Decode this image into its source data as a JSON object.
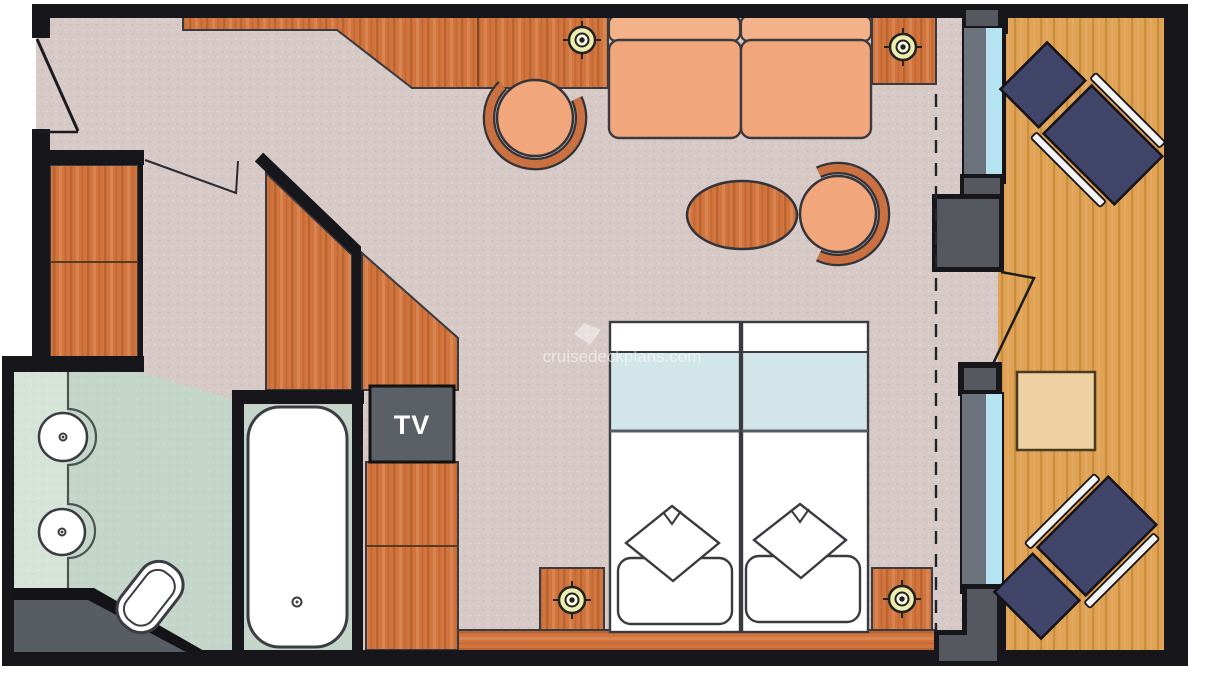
{
  "labels": {
    "tv": "TV"
  },
  "watermark": {
    "text": "cruisedeckplans.com"
  },
  "palette": {
    "wall": "#17171b",
    "carpet": "#d7c9c6",
    "bath_floor": "#c4d6c9",
    "bath_counter": "#d6e4d8",
    "wood": "#d3743c",
    "deck": "#e0a355",
    "deck_stripe": "#b97f2e",
    "upholstery": "#f1a67c",
    "upholstery_light": "#f4b28a",
    "chair_wood": "#cb7040",
    "lounge_navy": "#404569",
    "rail_white": "#f4f4f4",
    "glass": "#b5e3f2",
    "frame_gray": "#6d737d",
    "pillar_gray": "#55595f",
    "tv_gray": "#5b5f66",
    "spotlight_yellow": "#ededb0",
    "bed_blue": "#d2e5e9",
    "balcony_table": "#edd1a3",
    "shower_gray": "#585d64",
    "outline": "#3a3a41"
  },
  "icons": [
    "entry-door-icon",
    "closet-icon",
    "wardrobe-icon",
    "desk-icon",
    "spotlight-icon",
    "sofa-icon",
    "armchair-icon",
    "coffee-table-icon",
    "side-table-icon",
    "tv-icon",
    "tv-cabinet-icon",
    "twin-bed-icon",
    "pillow-icon",
    "nightstand-icon",
    "vanity-counter-icon",
    "sink-icon",
    "toilet-icon",
    "bathtub-icon",
    "shower-wall-icon",
    "window-icon",
    "balcony-door-icon",
    "curtain-track-icon",
    "lounge-chair-icon",
    "balcony-side-table-icon",
    "deck-icon"
  ]
}
